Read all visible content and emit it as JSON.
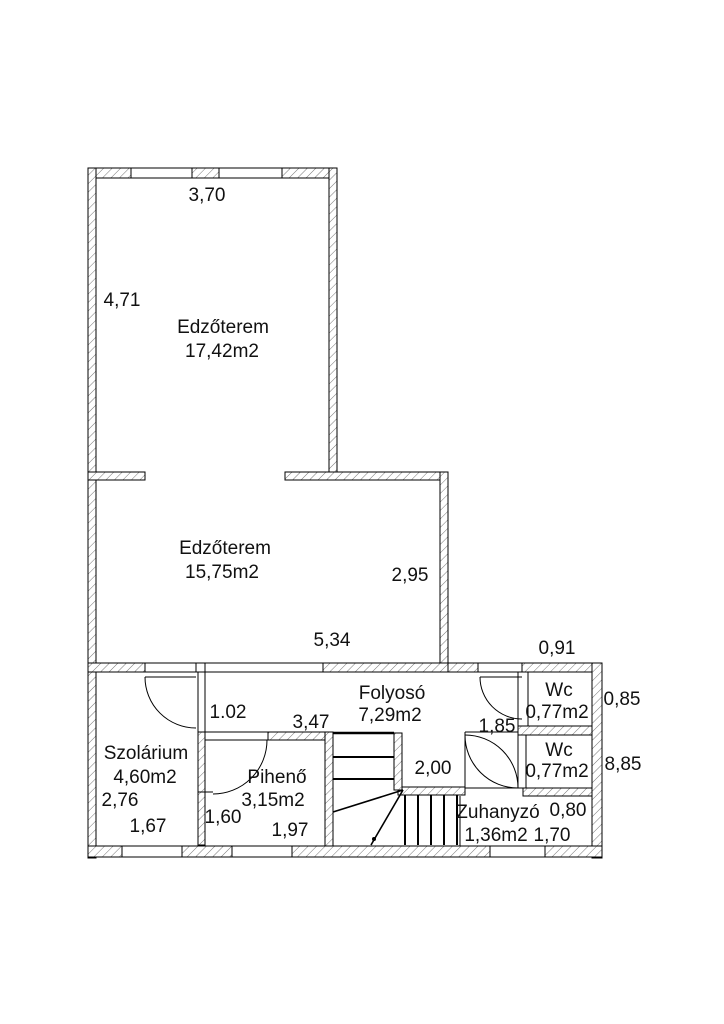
{
  "plan": {
    "type": "floor-plan",
    "rooms": {
      "gym_upper": {
        "name": "Edzőterem",
        "area": "17,42m2"
      },
      "gym_lower": {
        "name": "Edzőterem",
        "area": "15,75m2"
      },
      "corridor": {
        "name": "Folyosó",
        "area": "7,29m2"
      },
      "solarium": {
        "name": "Szolárium",
        "area": "4,60m2"
      },
      "rest_room": {
        "name": "Pihenő",
        "area": "3,15m2"
      },
      "wc_1": {
        "name": "Wc",
        "area": "0,77m2"
      },
      "wc_2": {
        "name": "Wc",
        "area": "0,77m2"
      },
      "shower": {
        "name": "Zuhanyzó",
        "area": "1,36m2"
      }
    },
    "dimensions": {
      "d370": "3,70",
      "d471": "4,71",
      "d295": "2,95",
      "d534": "5,34",
      "d091": "0,91",
      "d102": "1.02",
      "d347": "3,47",
      "d185": "1,85",
      "d085": "0,85",
      "d885": "8,85",
      "d200": "2,00",
      "d276": "2,76",
      "d167": "1,67",
      "d160": "1,60",
      "d197": "1,97",
      "d080": "0,80",
      "d170": "1,70"
    },
    "colors": {
      "line": "#000000",
      "hatch": "#777777",
      "background": "#ffffff"
    }
  }
}
